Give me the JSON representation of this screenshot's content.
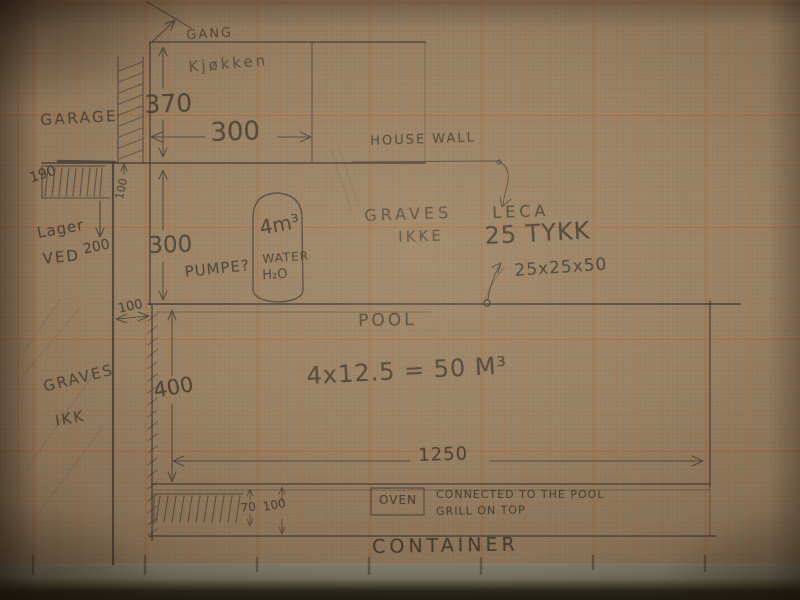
{
  "scene": {
    "description": "Hand-drawn pencil floor-plan sketch of a house, garage and swimming pool on orange millimeter graph paper, photographed on a table",
    "paper_color": "#9a8468",
    "grid_color": "#c15e28",
    "pencil_color": "#45403a"
  },
  "rooms": {
    "gang": "GANG",
    "kitchen": "Kjøkken",
    "garage": "GARAGE",
    "wood_storage_line1": "Lager",
    "wood_storage_line2": "VED",
    "pool": "POOL",
    "container": "CONTAINER",
    "oven": "OVEN"
  },
  "annotations": {
    "house_wall": "HOUSE WALL",
    "graves_line1": "GRAVES",
    "graves_line2": "IKKE",
    "leca": "LECA",
    "leca_thickness": "25 TYKK",
    "leca_block_size": "25x25x50",
    "pool_volume": "4x12.5 = 50 M³",
    "tank_volume": "4m³",
    "tank_water": "WATER",
    "tank_h2o": "H₂O",
    "pump": "PUMPE?",
    "graves_left_line1": "GRAVES",
    "graves_left_line2": "IKK",
    "oven_note_line1": "CONNECTED TO THE POOL",
    "oven_note_line2": "GRILL ON TOP"
  },
  "dimensions": {
    "kitchen_depth": "370",
    "kitchen_width": "300",
    "room_below_kitchen": "300",
    "garage_opening": "190",
    "garage_wall_thickness": "100",
    "wood_storage": "200",
    "wall_to_pool_gap": "100",
    "pool_width": "400",
    "pool_length": "1250",
    "ledge_thickness": "70",
    "container_height": "100"
  }
}
